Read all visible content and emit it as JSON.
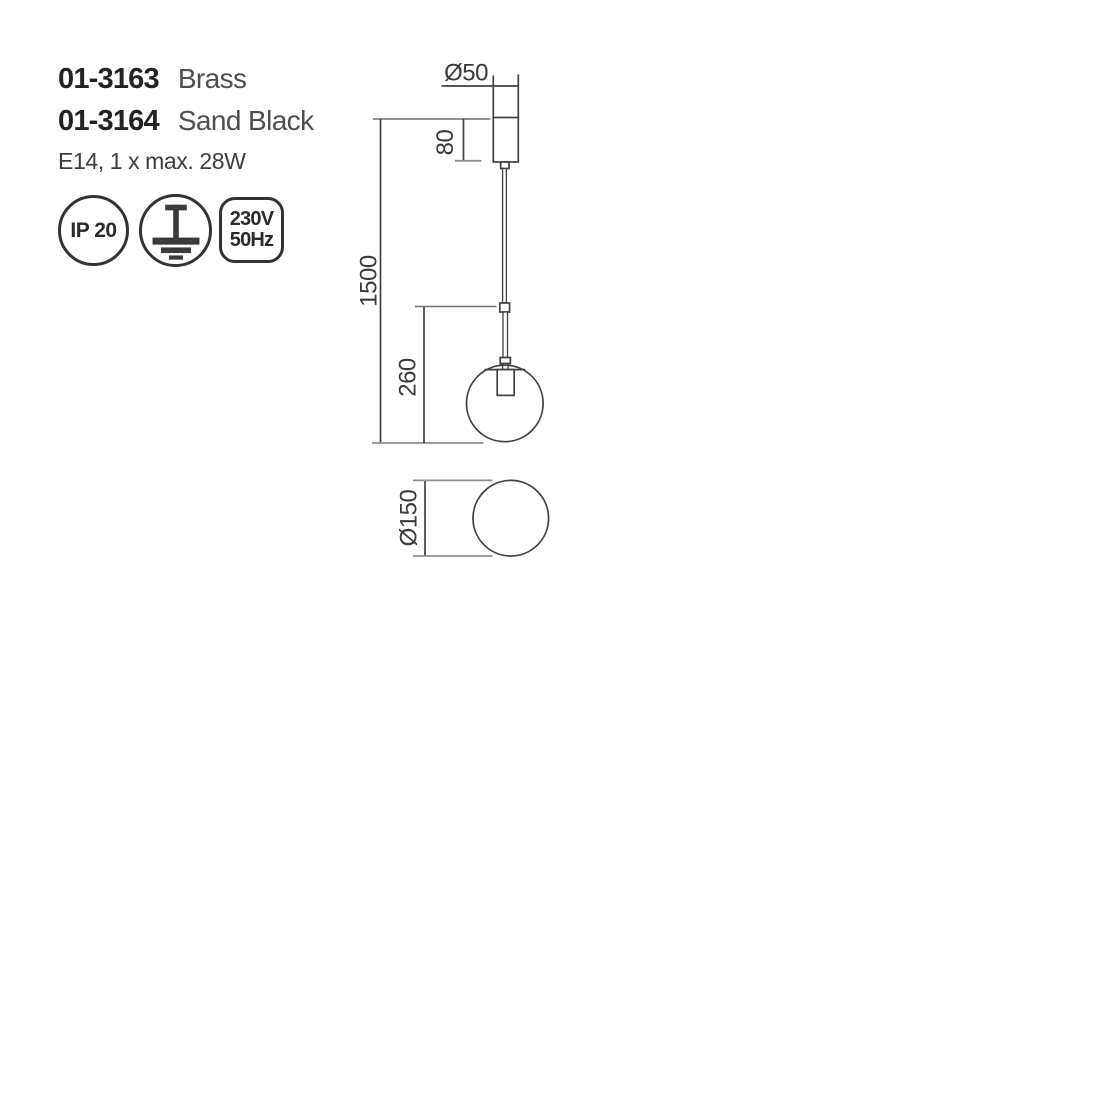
{
  "product": {
    "variants": [
      {
        "code": "01-3163",
        "finish": "Brass"
      },
      {
        "code": "01-3164",
        "finish": "Sand Black"
      }
    ],
    "lamp_spec": "E14, 1 x max. 28W"
  },
  "badges": {
    "ip_rating": "IP 20",
    "earth_icon": "protective-earth-icon",
    "voltage": "230V",
    "frequency": "50Hz"
  },
  "drawing": {
    "front_view": {
      "canopy_diameter": "Ø50",
      "canopy_height": "80",
      "total_height": "1500",
      "pendant_height": "260"
    },
    "top_view": {
      "globe_diameter": "Ø150"
    }
  },
  "colors": {
    "line": "#414141",
    "extension_line": "#909090",
    "badge_outline": "#333333",
    "code_text": "#232323",
    "body_text": "#3c3c3c",
    "background": "#ffffff"
  }
}
